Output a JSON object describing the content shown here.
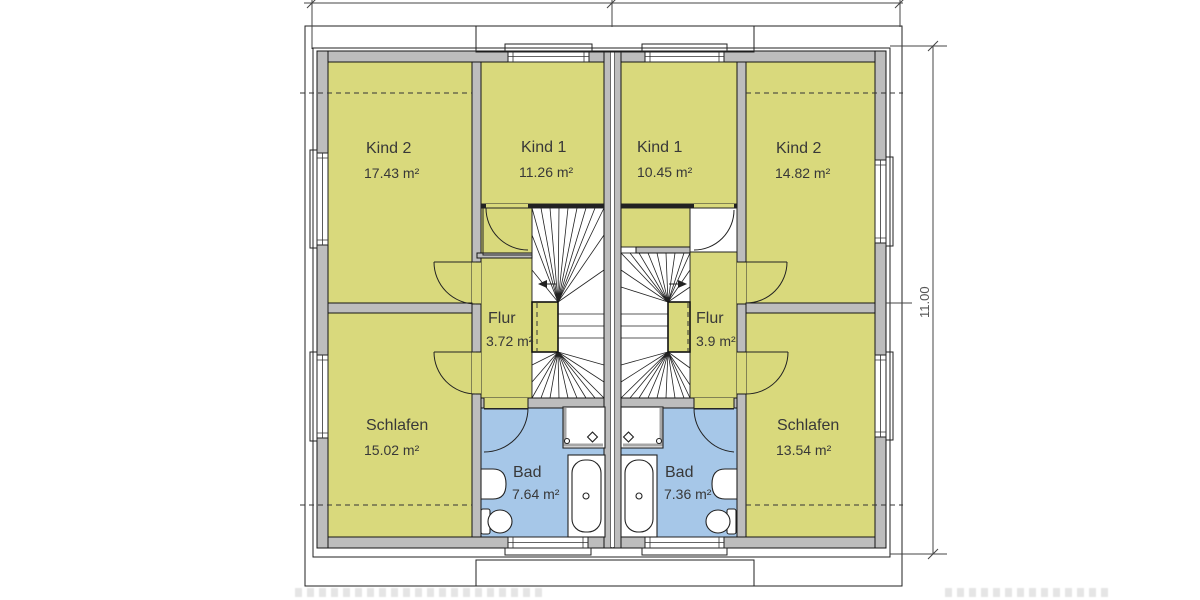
{
  "drawing": {
    "type": "floor-plan",
    "rooms": [
      {
        "id": "kind2-left",
        "name": "Kind 2",
        "area": "17.43 m²"
      },
      {
        "id": "kind1-left",
        "name": "Kind 1",
        "area": "11.26 m²"
      },
      {
        "id": "kind1-right",
        "name": "Kind 1",
        "area": "10.45 m²"
      },
      {
        "id": "kind2-right",
        "name": "Kind 2",
        "area": "14.82 m²"
      },
      {
        "id": "flur-left",
        "name": "Flur",
        "area": "3.72 m²"
      },
      {
        "id": "flur-right",
        "name": "Flur",
        "area": "3.9 m²"
      },
      {
        "id": "schlafen-left",
        "name": "Schlafen",
        "area": "15.02 m²"
      },
      {
        "id": "schlafen-right",
        "name": "Schlafen",
        "area": "13.54 m²"
      },
      {
        "id": "bad-left",
        "name": "Bad",
        "area": "7.64 m²"
      },
      {
        "id": "bad-right",
        "name": "Bad",
        "area": "7.36 m²"
      }
    ],
    "dimensions": {
      "height_label": "11.00"
    },
    "colors": {
      "room_fill": "#d9d97c",
      "bath_fill": "#a6c7e8",
      "wall_fill": "#bdbdbd"
    }
  }
}
